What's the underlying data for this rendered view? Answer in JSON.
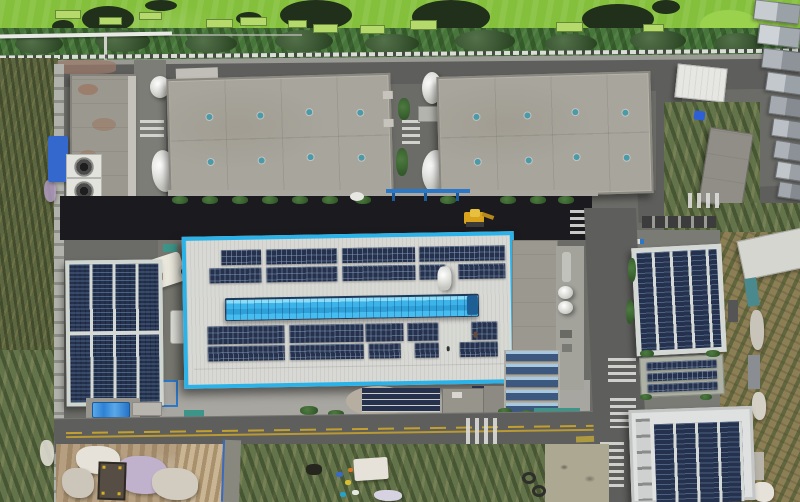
{
  "scene": {
    "type": "aerial-drone-photograph",
    "setting": "industrial park with rooftop solar installations, viewed top-down",
    "time_of_day": "daytime",
    "visible_text": "none",
    "description": "Top-down aerial photo of an industrial facility: an algae-covered green pond strip and tree line at top, two large gray warehouse roofs with teal skylight vents, a central white factory roof with bright cyan-blue trim holding rows of solar panels and a blue skylight monitor, a fully solar-covered building on the left, two solar-roofed buildings on the right, asphalt roads with zebra crosswalks and yellow center lines, construction dirt with tarps at bottom, and a brown crop field along the right edge.",
    "landmarks": [
      "algae-pond-strip",
      "tree-line",
      "perimeter-road",
      "warehouse-roof-left",
      "warehouse-roof-right",
      "central-factory-solar-roof",
      "blue-skylight-monitor",
      "left-solar-building",
      "right-solar-building-upper",
      "right-solar-building-lower",
      "cooling-fan-units",
      "white-silos",
      "gantry-crane",
      "excavator",
      "crosswalks",
      "dirt-lot-with-tarps",
      "crop-field"
    ]
  },
  "palette": {
    "asphalt": "#6b6b67",
    "road": "#5e5e5c",
    "darkStrip": "#1b1b1f",
    "concrete": "#a7a59c",
    "concreteEdge": "#8b897f",
    "whiteroof": "#d8d9d4",
    "borderBlue": "#2bb2e8",
    "skyTop": "#8adcf8",
    "skyMid": "#2f9fd8",
    "solarNavy": "#25314d",
    "panelGap": "#d6dad6",
    "teal": "#4a9aaa",
    "algae": "#85c03c",
    "algaeDark": "#20301a",
    "algaeBright": "#9ad24e",
    "platform": "#b5d96a",
    "tree": "#47763a",
    "treeDark": "#36592c",
    "reeds": "#5c6640",
    "scrub": "#64744a",
    "field": "#8c7f55",
    "dirt": "#b59f80",
    "dirtLight": "#c9b594",
    "shrubGreen": "#4e7a40",
    "tarpBlue": "#3568cc",
    "canopyBlue": "#2e82d6",
    "gantryBlue": "#2b78c8",
    "truckBlue": "#2f5fd6",
    "excavYellow": "#d8a21c",
    "roadYellow": "#c2a030",
    "paint": "#dcdcd8",
    "wall": "#b2b2ac",
    "rust": "#9a6a4e",
    "tarpWhite": "#e6e2da",
    "tarpLav": "#c0b2cc",
    "shedDark": "#564e44",
    "redTruck": "#a03226",
    "tealFence": "#3d9488",
    "silo": "#eeeeea"
  }
}
